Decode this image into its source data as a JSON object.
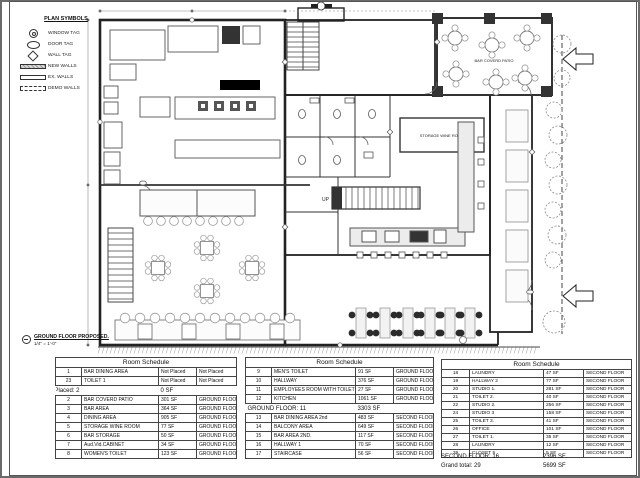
{
  "legend": {
    "title": "PLAN SYMBOLS",
    "items": [
      {
        "name": "window-tag",
        "label": "WINDOW TAG"
      },
      {
        "name": "door-tag",
        "label": "DOOR TAG"
      },
      {
        "name": "wall-tag",
        "label": "WALL TAG"
      },
      {
        "name": "new-walls",
        "label": "NEW WALLS"
      },
      {
        "name": "ex-walls",
        "label": "EX. WALLS"
      },
      {
        "name": "demo-walls",
        "label": "DEMO WALLS"
      }
    ]
  },
  "plan": {
    "title": "GROUND FLOOR PROPOSED.",
    "scale": "1/4\" = 1'-0\"",
    "labels": {
      "patio": "BAR COVERD PATIO",
      "wine_room": "STORAGE WINE ROOM",
      "up": "UP"
    }
  },
  "schedules": [
    {
      "title": "Room Schedule",
      "rows_top": [
        [
          "1",
          "BAR DINING AREA",
          "Not Placed",
          "Not Placed"
        ],
        [
          "23",
          "TOILET 1",
          "Not Placed",
          "Not Placed"
        ]
      ],
      "summary": {
        "label": "Not Placed: 2",
        "value": "0 SF"
      },
      "rows_bottom": [
        [
          "2",
          "BAR COVERD PATIO",
          "301 SF",
          "GROUND FLOOR"
        ],
        [
          "3",
          "BAR AREA",
          "364 SF",
          "GROUND FLOOR"
        ],
        [
          "4",
          "DINING AREA",
          "905 SF",
          "GROUND FLOOR"
        ],
        [
          "5",
          "STORAGE WINE ROOM",
          "77 SF",
          "GROUND FLOOR"
        ],
        [
          "6",
          "BAR STORAGE",
          "50 SF",
          "GROUND FLOOR"
        ],
        [
          "7",
          "Aud.Vid.CABINET",
          "34 SF",
          "GROUND FLOOR"
        ],
        [
          "8",
          "WOMEN'S TOILET",
          "123 SF",
          "GROUND FLOOR"
        ]
      ]
    },
    {
      "title": "Room Schedule",
      "rows_top": [
        [
          "9",
          "MEN'S TOILET",
          "91 SF",
          "GROUND FLOOR"
        ],
        [
          "10",
          "HALLWAY",
          "376 SF",
          "GROUND FLOOR"
        ],
        [
          "11",
          "EMPLOYEES ROOM WITH TOILET",
          "27 SF",
          "GROUND FLOOR"
        ],
        [
          "12",
          "KITCHEN",
          "1061 SF",
          "GROUND FLOOR"
        ]
      ],
      "summary": {
        "label": "GROUND FLOOR: 11",
        "value": "3303 SF"
      },
      "rows_bottom": [
        [
          "13",
          "BAR DINING AREA 2nd",
          "483 SF",
          "SECOND FLOOR"
        ],
        [
          "14",
          "BALCONY AREA",
          "649 SF",
          "SECOND FLOOR"
        ],
        [
          "15",
          "BAR AREA 2ND.",
          "117 SF",
          "SECOND FLOOR"
        ],
        [
          "16",
          "HALLWAY 1",
          "70 SF",
          "SECOND FLOOR"
        ],
        [
          "17",
          "STAIRCASE",
          "56 SF",
          "SECOND FLOOR"
        ]
      ]
    },
    {
      "title": "Room Schedule",
      "rows_top": [
        [
          "18",
          "LAUNDRY",
          "47 SF",
          "SECOND FLOOR"
        ],
        [
          "19",
          "HALLWAY 2",
          "77 SF",
          "SECOND FLOOR"
        ],
        [
          "20",
          "STUDIO 1.",
          "281 SF",
          "SECOND FLOOR"
        ],
        [
          "21",
          "TOILET 2.",
          "40 SF",
          "SECOND FLOOR"
        ],
        [
          "22",
          "STUDIO 2.",
          "256 SF",
          "SECOND FLOOR"
        ],
        [
          "24",
          "STUDIO 3",
          "158 SF",
          "SECOND FLOOR"
        ],
        [
          "25",
          "TOILET 3.",
          "41 SF",
          "SECOND FLOOR"
        ],
        [
          "26",
          "OFFICE",
          "101 SF",
          "SECOND FLOOR"
        ],
        [
          "27",
          "TOILET 1.",
          "35 SF",
          "SECOND FLOOR"
        ],
        [
          "28",
          "LAUNDRY",
          "12 SF",
          "SECOND FLOOR"
        ],
        [
          "29",
          "CLOSET 5",
          "5 SF",
          "SECOND FLOOR"
        ]
      ],
      "footers": [
        {
          "label": "SECOND FLOOR: 16",
          "value": "2396 SF"
        },
        {
          "label": "Grand total: 29",
          "value": "5699 SF"
        }
      ]
    }
  ]
}
